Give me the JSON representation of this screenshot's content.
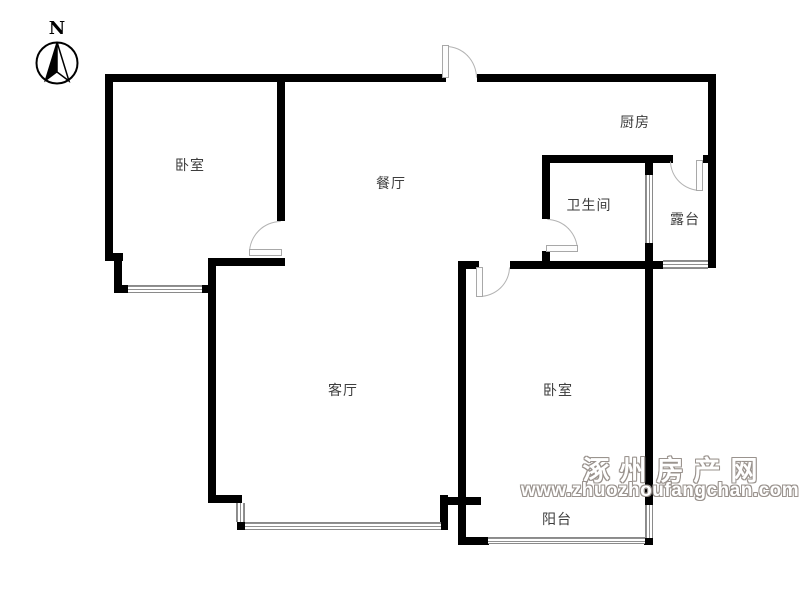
{
  "compass": {
    "north_label": "N"
  },
  "rooms": {
    "bedroom1": {
      "label": "卧室"
    },
    "dining": {
      "label": "餐厅"
    },
    "kitchen": {
      "label": "厨房"
    },
    "bathroom": {
      "label": "卫生间"
    },
    "terrace": {
      "label": "露台"
    },
    "living": {
      "label": "客厅"
    },
    "bedroom2": {
      "label": "卧室"
    },
    "balcony": {
      "label": "阳台"
    }
  },
  "watermark": {
    "site_name": "涿州房产网",
    "site_url": "www.zhuozhoufangchan.com",
    "color": "#9a938e"
  },
  "colors": {
    "wall": "#000000",
    "door": "#b3b3b3",
    "window": "#909090",
    "background": "#ffffff"
  }
}
